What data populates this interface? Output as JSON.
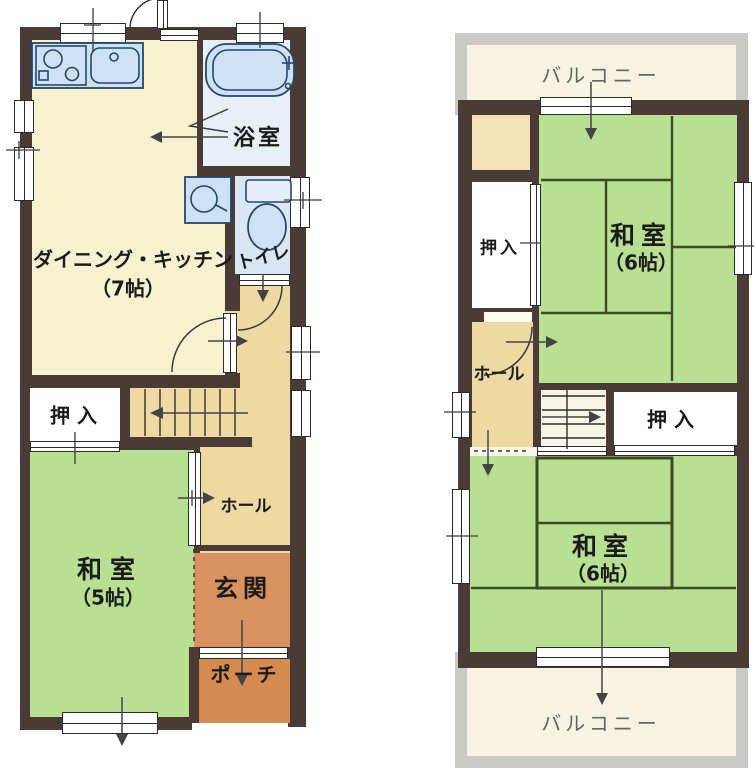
{
  "plan": {
    "type": "japanese-floor-plan",
    "floors": 2
  },
  "colors": {
    "wall": "#4b3b37",
    "cream": "#f8f1d0",
    "cream2": "#f3e3b6",
    "green": "#b7e092",
    "tan": "#eed9a3",
    "orange": "#d9925f",
    "porch": "#d58a52",
    "blue": "#cde2f4",
    "bathfloor": "#e9eff7",
    "toiletfloor": "#d9e7f4",
    "ivory": "#f6f3e2",
    "gray": "#c9cac5",
    "white": "#ffffff",
    "stair_bg": "#f8f4e6",
    "tatami_line": "#3c4a26",
    "fixture_line": "#27466b",
    "text": "#1b1b1b",
    "text_gray": "#63665c"
  },
  "floor1": {
    "rooms": {
      "dk": "ダイニング・キッチン",
      "dk_size": "（7帖）",
      "bath": "浴室",
      "toilet": "トイレ",
      "closet": "押入",
      "tatami": "和室",
      "tatami_size": "（5帖）",
      "hall": "ホール",
      "entrance": "玄関",
      "porch": "ポーチ"
    }
  },
  "floor2": {
    "rooms": {
      "balcony": "バルコニー",
      "closet": "押入",
      "tatami": "和室",
      "tatami_size": "（6帖）",
      "hall": "ホール"
    }
  }
}
